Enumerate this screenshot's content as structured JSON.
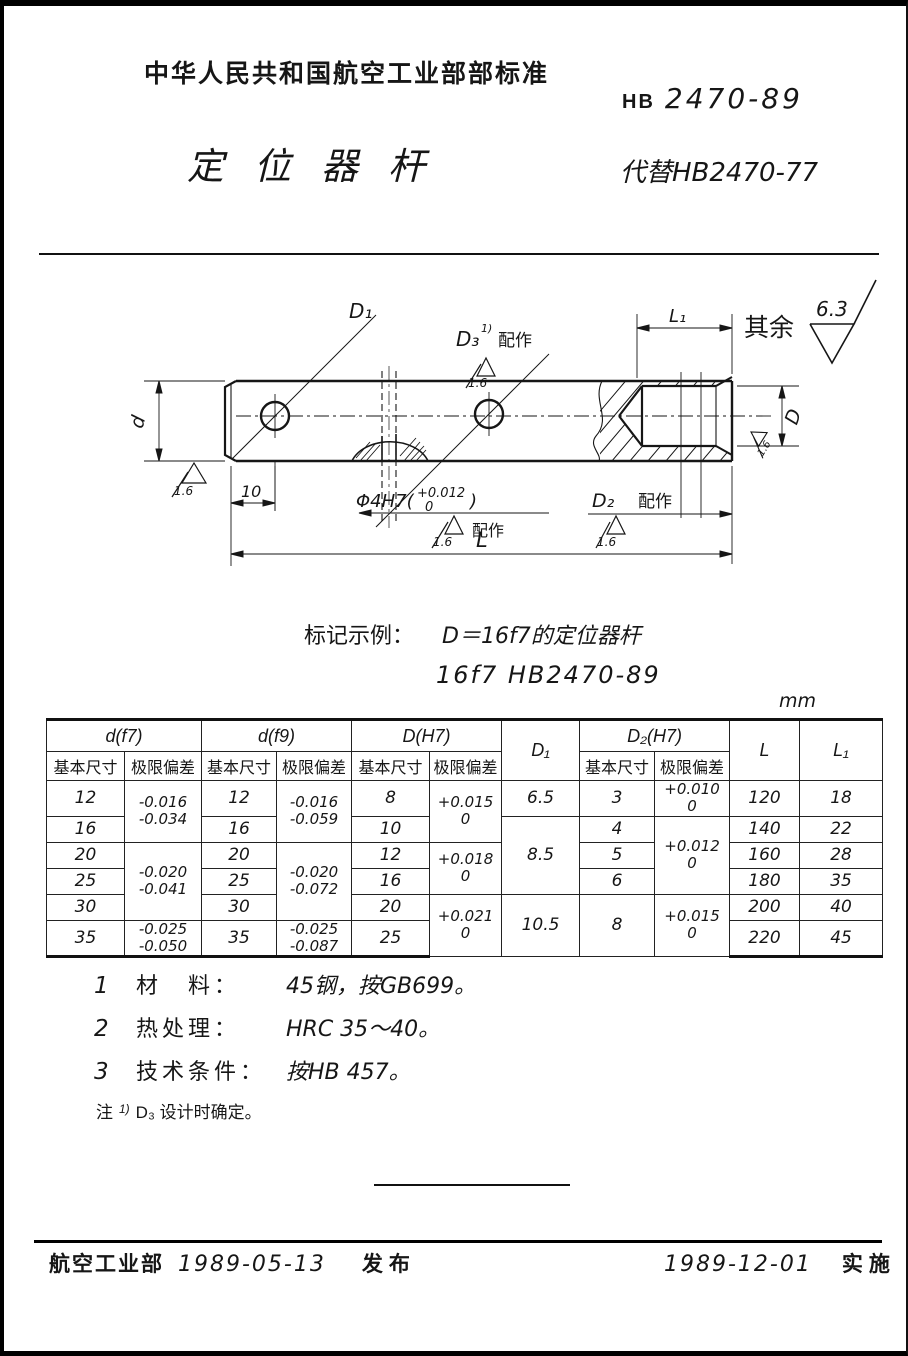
{
  "header": {
    "org_standard": "中华人民共和国航空工业部部标准",
    "code_prefix": "HB",
    "code_number": "2470-89",
    "title": "定位器杆",
    "replaces": "代替HB2470-77"
  },
  "drawing": {
    "labels": {
      "d1": "D₁",
      "d3": "D₃",
      "d3_sup": "1)",
      "fit_note_1": "配作",
      "fit_note_2": "配作",
      "fit_note_3": "配作",
      "l1": "L₁",
      "rest_label": "其余",
      "rest_roughness": "6.3",
      "r16_a": "1.6",
      "r16_b": "1.6",
      "r16_c": "1.6",
      "r16_d": "1.6",
      "r16_e": "1.6",
      "dim_d": "d",
      "dim_D": "D",
      "dim_10": "10",
      "phi_main": "Φ4H7(",
      "phi_tol_up": "+0.012",
      "phi_tol_dn": "0",
      "phi_close": ")",
      "d2": "D₂",
      "L": "L"
    }
  },
  "example": {
    "label": "标记示例：",
    "line1": "D＝16f7的定位器杆",
    "line2": "16f7  HB2470-89"
  },
  "table": {
    "unit": "mm",
    "head": {
      "d_f7": "d(f7)",
      "d_f9": "d(f9)",
      "D_H7": "D(H7)",
      "D1": "D₁",
      "D2_H7": "D₂(H7)",
      "L": "L",
      "L1": "L₁",
      "basic1": "基本尺寸",
      "dev1": "极限偏差",
      "basic2": "基本尺寸",
      "dev2": "极限偏差",
      "basic3": "基本尺寸",
      "dev3": "极限偏差",
      "basic4": "基本尺寸",
      "dev4": "极限偏差"
    },
    "rows": [
      [
        "12",
        "-0.016\n-0.034",
        "12",
        "-0.016\n-0.059",
        "8",
        "+0.015\n0",
        "6.5",
        "3",
        "+0.010\n0",
        "120",
        "18"
      ],
      [
        "16",
        "16",
        "10",
        "8.5",
        "4",
        "+0.012\n0",
        "140",
        "22"
      ],
      [
        "20",
        "-0.020\n-0.041",
        "20",
        "-0.020\n-0.072",
        "12",
        "+0.018\n0",
        "5",
        "160",
        "28"
      ],
      [
        "25",
        "25",
        "16",
        "6",
        "180",
        "35"
      ],
      [
        "30",
        "30",
        "20",
        "+0.021\n0",
        "10.5",
        "8",
        "+0.015\n0",
        "200",
        "40"
      ],
      [
        "35",
        "-0.025\n-0.050",
        "35",
        "-0.025\n-0.087",
        "25",
        "220",
        "45"
      ]
    ]
  },
  "notes": {
    "n1_num": "1",
    "n1_label": "材　料：",
    "n1_text": "45钢，按GB699。",
    "n2_num": "2",
    "n2_label": "热处理：",
    "n2_text": "HRC 35～40。",
    "n3_num": "3",
    "n3_label": "技术条件：",
    "n3_text": "按HB 457。",
    "footnote_label": "注",
    "footnote_sup": "1)",
    "footnote_text": "D₃ 设计时确定。"
  },
  "footer": {
    "issuer": "航空工业部",
    "issue_date": "1989-05-13",
    "issue_word": "发布",
    "impl_date": "1989-12-01",
    "impl_word": "实施"
  }
}
